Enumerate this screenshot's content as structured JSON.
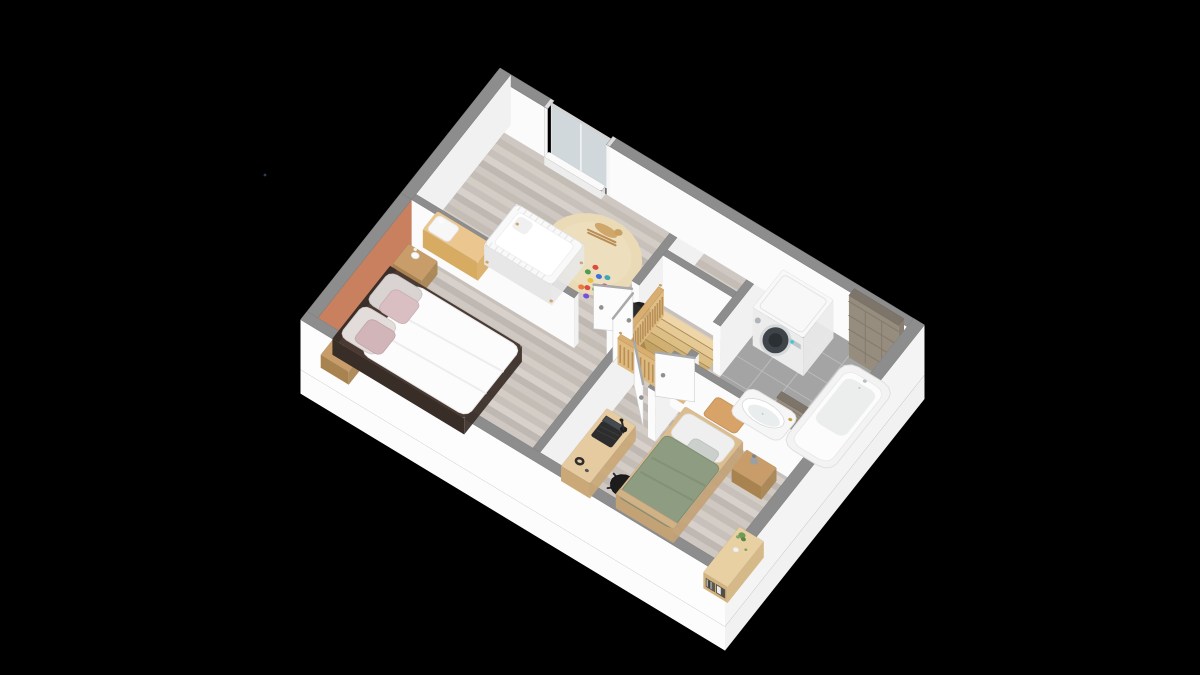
{
  "scene": {
    "width": 1200,
    "height": 675,
    "background": "#000000",
    "proj": {
      "ox": 500,
      "oy": 118,
      "ux": 0.4516,
      "uy": 0.2734,
      "vx": -0.2696,
      "vy": 0.34,
      "H": 50,
      "slab": 24
    },
    "colors": {
      "wallTop": "#8d8d8d",
      "wallEdge": "#7e7e7e",
      "faceS": "#fbfbfb",
      "faceE": "#f1f1f1",
      "ext": "#fdfdfd",
      "extE": "#f4f4f4",
      "slabS": "#fcfcfc",
      "slabE": "#f1f1f1",
      "accent": "#c8805f",
      "glass": "#e2ebee",
      "tileTop": "#7d756a",
      "tileS": "#978d7f",
      "tileE": "#887f72",
      "tileLine": "#857b6d",
      "woodBase": "#ccc5bf",
      "planks": [
        "#d4cdc7",
        "#c3bbb5",
        "#cfc8c2",
        "#beb6b0",
        "#d9d2cc",
        "#c8c0ba"
      ],
      "bathBase": "#a4a4a4",
      "bathLine": "#bdbdbd",
      "stairBase": "#caa265",
      "stairNose": "#8a6b3e",
      "railTop": "#d9ae71",
      "railFace": "#dfba7f",
      "railStripe": "#b78f57",
      "railKnob": "#c9a061",
      "leaf": "#fcfcfc",
      "leafEdge": "#a9a9a9",
      "leafStroke": "#cfcfcf",
      "handle": "#909090"
    },
    "slabDepth": 24,
    "footprint": [
      0,
      0,
      940,
      740
    ],
    "floorInner": [
      24,
      24,
      892,
      692
    ],
    "bathFloor": {
      "r": [
        636,
        24,
        280,
        328
      ],
      "nx": 5,
      "ny": 6
    },
    "stairFloor": {
      "r": [
        476,
        186,
        134,
        160
      ],
      "treads": 8,
      "cols": [
        "#eed6a8",
        "#e5ca96",
        "#dcbf85",
        "#d1b173",
        "#c4a262",
        "#b69254",
        "#a8844a",
        "#9a7741"
      ]
    },
    "rug": {
      "c": [
        300,
        160
      ],
      "r": 95,
      "fill": "#eadbb6",
      "inner": "#f0e4c4"
    },
    "toys": [
      [
        320,
        182,
        "#d94f3f"
      ],
      [
        336,
        196,
        "#3f6fd9"
      ],
      [
        328,
        214,
        "#e8c23f"
      ],
      [
        346,
        226,
        "#4f9e4f"
      ],
      [
        322,
        238,
        "#e87a3f"
      ],
      [
        340,
        250,
        "#7a4fd9"
      ],
      [
        356,
        208,
        "#c43f8e"
      ],
      [
        314,
        200,
        "#4f9e4f"
      ],
      [
        350,
        188,
        "#3fa7b8"
      ],
      [
        332,
        232,
        "#d94f3f"
      ]
    ],
    "artifactDot": {
      "x": 265,
      "y": 175,
      "r": 1.4,
      "fill": "#2e3c55"
    },
    "walls": [
      {
        "name": "north-wall-west",
        "r": [
          0,
          0,
          112,
          24
        ],
        "f": [
          "S"
        ]
      },
      {
        "name": "north-wall-east",
        "r": [
          258,
          0,
          682,
          24
        ],
        "f": [
          "S"
        ]
      },
      {
        "name": "window-post-left",
        "r": [
          112,
          0,
          8,
          24
        ],
        "f": [
          "S"
        ],
        "top": "#dcdcdc",
        "fc": "#f6f6f6"
      },
      {
        "name": "window-post-right",
        "r": [
          250,
          0,
          8,
          24
        ],
        "f": [
          "S"
        ],
        "top": "#dcdcdc",
        "fc": "#f6f6f6"
      },
      {
        "name": "window-glass",
        "t": "glass",
        "a": [
          120,
          10
        ],
        "b": [
          250,
          10
        ]
      },
      {
        "name": "west-wall-north",
        "r": [
          0,
          0,
          24,
          368
        ],
        "f": [
          "E"
        ]
      },
      {
        "name": "west-wall-accent",
        "r": [
          0,
          368,
          24,
          348
        ],
        "f": [
          "E"
        ],
        "fcE": "#c8805f"
      },
      {
        "name": "south-wall",
        "r": [
          0,
          716,
          940,
          24
        ],
        "f": [
          "Sx"
        ]
      },
      {
        "name": "east-wall",
        "r": [
          916,
          0,
          24,
          740
        ],
        "f": [
          "Ex"
        ]
      },
      {
        "name": "nursery-east-wall",
        "r": [
          450,
          24,
          16,
          240
        ],
        "f": [
          "E",
          "S"
        ]
      },
      {
        "name": "middle-wall-west",
        "r": [
          24,
          352,
          360,
          16
        ],
        "f": [
          "S",
          "E"
        ]
      },
      {
        "name": "middle-wall-center",
        "r": [
          456,
          352,
          60,
          16
        ],
        "f": [
          "S",
          "E"
        ]
      },
      {
        "name": "middle-wall-east",
        "r": [
          596,
          352,
          344,
          16
        ],
        "f": [
          "S"
        ]
      },
      {
        "name": "master-east-wall",
        "r": [
          500,
          368,
          16,
          348
        ],
        "f": [
          "E"
        ]
      },
      {
        "name": "bath-west-wall-north",
        "r": [
          620,
          24,
          16,
          224
        ],
        "f": [
          "E",
          "S"
        ]
      },
      {
        "name": "bath-west-wall-south",
        "r": [
          620,
          328,
          16,
          24
        ],
        "f": [
          "E",
          "S"
        ]
      },
      {
        "name": "stair-north-wall",
        "r": [
          466,
          160,
          154,
          16
        ],
        "f": [
          "S",
          "E"
        ]
      },
      {
        "name": "bedroom2-niche-wall",
        "r": [
          600,
          368,
          16,
          88
        ],
        "f": [
          "S",
          "E"
        ]
      },
      {
        "name": "tiled-wall-north",
        "t": "tiled",
        "r": [
          806,
          36,
          110,
          20
        ],
        "h": 62
      },
      {
        "name": "tiled-wall-south",
        "t": "tiled",
        "r": [
          800,
          296,
          78,
          18
        ],
        "h": 46
      }
    ],
    "objects": [
      {
        "t": "box",
        "name": "washing-machine",
        "r": [
          648,
          36,
          112,
          112
        ],
        "h": 38,
        "top": "#f8f8f8",
        "side": "#ececec",
        "deco": "washer"
      },
      {
        "t": "box",
        "name": "window-sill",
        "r": [
          122,
          24,
          126,
          16
        ],
        "h": 8,
        "top": "#fafafa",
        "side": "#ededed"
      },
      {
        "t": "flat",
        "name": "bath-mat",
        "r": [
          655,
          292,
          72,
          54
        ],
        "rx": 8,
        "fill": "#d7a368",
        "stroke": "#c6955c"
      },
      {
        "t": "sink",
        "name": "washbasin",
        "r": [
          692,
          232,
          110,
          80
        ]
      },
      {
        "t": "tub",
        "name": "bathtub",
        "r": [
          806,
          64,
          108,
          244
        ]
      },
      {
        "t": "crib",
        "name": "crib",
        "r": [
          150,
          190,
          150,
          120
        ],
        "h": 20
      },
      {
        "t": "horse",
        "name": "rocking-horse",
        "c": [
          292,
          96
        ]
      },
      {
        "t": "chair1",
        "name": "nursery-chair",
        "c": [
          420,
          232
        ]
      },
      {
        "t": "box",
        "name": "changing-table",
        "r": [
          38,
          296,
          122,
          54
        ],
        "h": 18,
        "top": "#ecc68f",
        "side": "#d8ab63",
        "deco": "pad"
      },
      {
        "t": "bedM",
        "name": "double-bed",
        "r": [
          30,
          458,
          292,
          214
        ],
        "h": 16
      },
      {
        "t": "nstand",
        "name": "nightstand-master-north",
        "r": [
          28,
          386,
          64,
          58
        ],
        "h": 13,
        "lamp": "white"
      },
      {
        "t": "nstand",
        "name": "nightstand-master-south",
        "r": [
          28,
          664,
          62,
          48
        ],
        "h": 13,
        "lamp": "white"
      },
      {
        "t": "nstand",
        "name": "nightstand-bedroom2",
        "r": [
          778,
          388,
          66,
          56
        ],
        "h": 13,
        "lamp": "grey"
      },
      {
        "t": "bed2",
        "name": "single-bed",
        "r": [
          636,
          378,
          128,
          258
        ],
        "h": 14
      },
      {
        "t": "desk",
        "name": "desk",
        "r": [
          522,
          478,
          64,
          170
        ],
        "h": 15,
        "zb": 8
      },
      {
        "t": "chair2",
        "name": "desk-chair",
        "c": [
          622,
          582
        ]
      },
      {
        "t": "sideboard",
        "name": "sideboard",
        "r": [
          862,
          556,
          54,
          134
        ],
        "h": 16
      },
      {
        "t": "leaf",
        "name": "door-nursery",
        "a": [
          452,
          268
        ],
        "b": [
          390,
          306
        ]
      },
      {
        "t": "leaf",
        "name": "door-master",
        "a": [
          459,
          350
        ],
        "b": [
          459,
          276
        ]
      },
      {
        "t": "leaf",
        "name": "door-bedroom2",
        "a": [
          518,
          370
        ],
        "b": [
          582,
          444
        ]
      },
      {
        "t": "leaf",
        "name": "door-bathroom",
        "a": [
          628,
          330
        ],
        "b": [
          562,
          366
        ]
      },
      {
        "t": "rail",
        "name": "stair-rail-west",
        "r": [
          468,
          196,
          12,
          152
        ]
      },
      {
        "t": "rail",
        "name": "stair-rail-south",
        "r": [
          468,
          336,
          146,
          12
        ]
      }
    ]
  }
}
